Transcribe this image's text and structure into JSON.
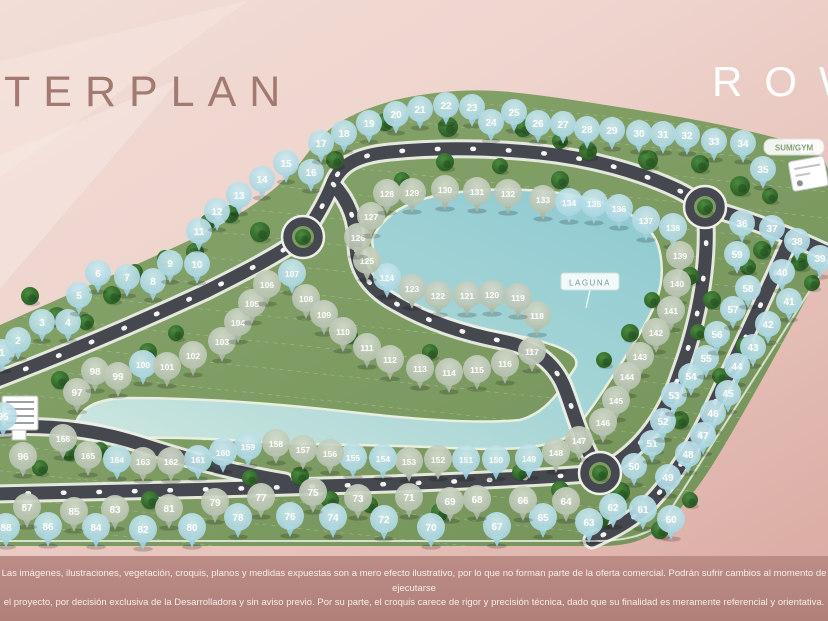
{
  "meta": {
    "title": "TERPLAN",
    "brand": "ROW"
  },
  "labels": {
    "laguna": "LAGUNA",
    "amenity": "SUM/GYM"
  },
  "disclaimer": {
    "line1": "Las imágenes, ilustraciones, vegetación, croquis, planos y medidas expuestas son a mero efecto ilustrativo, por lo que no forman parte de la oferta comercial. Podrán sufrir cambios al momento de ejecutarse",
    "line2": "el proyecto, por decisión exclusiva de la Desarrolladora y sin aviso previo. Por su parte, el croquis carece de rigor y precisión técnica, dado que su finalidad es meramente referencial y orientativa."
  },
  "colors": {
    "marker_blue": "#a9d8e4",
    "marker_sage": "#b6c2b2",
    "road": "#45484e",
    "terrain": "#7e9c62",
    "water": "#9fd2d8",
    "band": "#ba8c85",
    "title": "#a27a72",
    "brand_text": "#ffffff"
  },
  "map": {
    "markers": [
      [
        1,
        2,
        352,
        "b"
      ],
      [
        2,
        18,
        340,
        "b"
      ],
      [
        3,
        42,
        322,
        "b"
      ],
      [
        4,
        68,
        322,
        "b"
      ],
      [
        5,
        79,
        295,
        "b"
      ],
      [
        6,
        98,
        273,
        "b"
      ],
      [
        7,
        127,
        277,
        "b"
      ],
      [
        8,
        153,
        281,
        "b"
      ],
      [
        9,
        170,
        263,
        "b"
      ],
      [
        10,
        197,
        264,
        "b"
      ],
      [
        11,
        199,
        231,
        "b"
      ],
      [
        12,
        217,
        211,
        "b"
      ],
      [
        13,
        239,
        195,
        "b"
      ],
      [
        14,
        262,
        179,
        "b"
      ],
      [
        15,
        286,
        163,
        "b"
      ],
      [
        16,
        311,
        172,
        "b"
      ],
      [
        17,
        321,
        143,
        "b"
      ],
      [
        18,
        344,
        133,
        "b"
      ],
      [
        19,
        369,
        123,
        "b"
      ],
      [
        20,
        396,
        114,
        "b"
      ],
      [
        21,
        420,
        109,
        "b"
      ],
      [
        22,
        446,
        105,
        "b"
      ],
      [
        23,
        472,
        107,
        "b"
      ],
      [
        24,
        491,
        122,
        "b"
      ],
      [
        25,
        514,
        112,
        "b"
      ],
      [
        26,
        538,
        123,
        "b"
      ],
      [
        27,
        563,
        124,
        "b"
      ],
      [
        28,
        587,
        129,
        "b"
      ],
      [
        29,
        612,
        130,
        "b"
      ],
      [
        30,
        639,
        133,
        "b"
      ],
      [
        31,
        663,
        134,
        "b"
      ],
      [
        32,
        687,
        135,
        "b"
      ],
      [
        33,
        714,
        141,
        "b"
      ],
      [
        34,
        743,
        143,
        "b"
      ],
      [
        35,
        763,
        169,
        "b"
      ],
      [
        36,
        742,
        223,
        "b"
      ],
      [
        37,
        772,
        228,
        "b"
      ],
      [
        38,
        797,
        241,
        "b"
      ],
      [
        39,
        820,
        258,
        "b"
      ],
      [
        40,
        782,
        272,
        "b"
      ],
      [
        41,
        789,
        301,
        "b"
      ],
      [
        42,
        768,
        324,
        "b"
      ],
      [
        43,
        753,
        347,
        "b"
      ],
      [
        44,
        737,
        366,
        "b"
      ],
      [
        45,
        728,
        393,
        "b"
      ],
      [
        46,
        713,
        413,
        "b"
      ],
      [
        47,
        703,
        435,
        "b"
      ],
      [
        48,
        688,
        454,
        "b"
      ],
      [
        49,
        668,
        477,
        "b"
      ],
      [
        50,
        634,
        466,
        "b"
      ],
      [
        51,
        652,
        443,
        "b"
      ],
      [
        52,
        663,
        421,
        "b"
      ],
      [
        53,
        674,
        395,
        "b"
      ],
      [
        54,
        691,
        376,
        "b"
      ],
      [
        55,
        706,
        358,
        "b"
      ],
      [
        56,
        717,
        334,
        "b"
      ],
      [
        57,
        733,
        309,
        "b"
      ],
      [
        58,
        748,
        288,
        "b"
      ],
      [
        59,
        737,
        254,
        "b"
      ],
      [
        60,
        671,
        519,
        "b"
      ],
      [
        61,
        643,
        509,
        "b"
      ],
      [
        62,
        613,
        507,
        "b"
      ],
      [
        63,
        589,
        522,
        "b"
      ],
      [
        64,
        566,
        501,
        "s"
      ],
      [
        65,
        543,
        517,
        "b"
      ],
      [
        66,
        523,
        500,
        "s"
      ],
      [
        67,
        497,
        526,
        "b"
      ],
      [
        68,
        477,
        499,
        "s"
      ],
      [
        69,
        450,
        501,
        "s"
      ],
      [
        70,
        431,
        527,
        "b"
      ],
      [
        71,
        409,
        497,
        "s"
      ],
      [
        72,
        384,
        519,
        "b"
      ],
      [
        73,
        358,
        498,
        "s"
      ],
      [
        74,
        333,
        517,
        "b"
      ],
      [
        75,
        313,
        492,
        "s"
      ],
      [
        76,
        290,
        516,
        "b"
      ],
      [
        77,
        261,
        497,
        "s"
      ],
      [
        78,
        238,
        517,
        "b"
      ],
      [
        79,
        215,
        502,
        "s"
      ],
      [
        80,
        192,
        527,
        "b"
      ],
      [
        81,
        169,
        508,
        "s"
      ],
      [
        82,
        143,
        529,
        "b"
      ],
      [
        83,
        115,
        509,
        "s"
      ],
      [
        84,
        96,
        527,
        "b"
      ],
      [
        85,
        74,
        511,
        "s"
      ],
      [
        86,
        48,
        526,
        "b"
      ],
      [
        87,
        27,
        507,
        "s"
      ],
      [
        88,
        6,
        527,
        "b"
      ],
      [
        95,
        3,
        416,
        "b"
      ],
      [
        96,
        23,
        456,
        "s"
      ],
      [
        97,
        77,
        392,
        "s"
      ],
      [
        98,
        95,
        371,
        "s"
      ],
      [
        99,
        118,
        376,
        "s"
      ],
      [
        100,
        143,
        364,
        "b"
      ],
      [
        101,
        167,
        366,
        "s"
      ],
      [
        102,
        193,
        355,
        "s"
      ],
      [
        103,
        222,
        341,
        "s"
      ],
      [
        104,
        238,
        322,
        "s"
      ],
      [
        105,
        252,
        303,
        "s"
      ],
      [
        106,
        267,
        284,
        "s"
      ],
      [
        107,
        292,
        273,
        "b"
      ],
      [
        108,
        306,
        298,
        "s"
      ],
      [
        109,
        324,
        314,
        "s"
      ],
      [
        110,
        343,
        331,
        "s"
      ],
      [
        111,
        367,
        347,
        "s"
      ],
      [
        112,
        390,
        359,
        "s"
      ],
      [
        113,
        420,
        368,
        "s"
      ],
      [
        114,
        449,
        372,
        "s"
      ],
      [
        115,
        477,
        369,
        "s"
      ],
      [
        116,
        505,
        363,
        "s"
      ],
      [
        117,
        532,
        351,
        "s"
      ],
      [
        118,
        537,
        315,
        "s"
      ],
      [
        119,
        518,
        297,
        "s"
      ],
      [
        120,
        492,
        294,
        "s"
      ],
      [
        121,
        467,
        295,
        "s"
      ],
      [
        122,
        438,
        295,
        "s"
      ],
      [
        123,
        412,
        288,
        "s"
      ],
      [
        124,
        387,
        277,
        "b"
      ],
      [
        125,
        367,
        260,
        "s"
      ],
      [
        126,
        358,
        237,
        "s"
      ],
      [
        127,
        371,
        216,
        "s"
      ],
      [
        128,
        387,
        193,
        "s"
      ],
      [
        129,
        412,
        192,
        "s"
      ],
      [
        130,
        445,
        189,
        "s"
      ],
      [
        131,
        477,
        191,
        "s"
      ],
      [
        132,
        508,
        193,
        "s"
      ],
      [
        133,
        543,
        199,
        "s"
      ],
      [
        134,
        569,
        202,
        "b"
      ],
      [
        135,
        594,
        203,
        "b"
      ],
      [
        136,
        619,
        208,
        "b"
      ],
      [
        137,
        646,
        220,
        "b"
      ],
      [
        138,
        673,
        227,
        "b"
      ],
      [
        139,
        680,
        255,
        "s"
      ],
      [
        140,
        677,
        283,
        "s"
      ],
      [
        141,
        671,
        310,
        "s"
      ],
      [
        142,
        656,
        332,
        "s"
      ],
      [
        143,
        640,
        356,
        "s"
      ],
      [
        144,
        627,
        376,
        "s"
      ],
      [
        145,
        616,
        400,
        "s"
      ],
      [
        146,
        603,
        422,
        "s"
      ],
      [
        147,
        579,
        440,
        "s"
      ],
      [
        148,
        556,
        452,
        "s"
      ],
      [
        149,
        529,
        458,
        "b"
      ],
      [
        150,
        496,
        459,
        "b"
      ],
      [
        151,
        466,
        459,
        "b"
      ],
      [
        152,
        438,
        459,
        "s"
      ],
      [
        153,
        409,
        461,
        "s"
      ],
      [
        154,
        383,
        458,
        "b"
      ],
      [
        155,
        353,
        457,
        "b"
      ],
      [
        156,
        330,
        453,
        "s"
      ],
      [
        157,
        303,
        449,
        "s"
      ],
      [
        158,
        276,
        443,
        "s"
      ],
      [
        159,
        248,
        446,
        "b"
      ],
      [
        160,
        223,
        452,
        "b"
      ],
      [
        161,
        198,
        459,
        "b"
      ],
      [
        162,
        171,
        461,
        "s"
      ],
      [
        163,
        143,
        461,
        "s"
      ],
      [
        164,
        117,
        459,
        "b"
      ],
      [
        165,
        88,
        455,
        "s"
      ],
      [
        166,
        63,
        438,
        "s"
      ]
    ],
    "trees": [
      [
        30,
        296,
        9
      ],
      [
        57,
        317,
        10
      ],
      [
        86,
        322,
        8
      ],
      [
        112,
        295,
        9
      ],
      [
        135,
        272,
        8
      ],
      [
        165,
        258,
        8
      ],
      [
        148,
        352,
        9
      ],
      [
        176,
        333,
        8
      ],
      [
        195,
        252,
        9
      ],
      [
        208,
        222,
        8
      ],
      [
        230,
        214,
        9
      ],
      [
        260,
        232,
        10
      ],
      [
        292,
        242,
        8
      ],
      [
        335,
        160,
        9
      ],
      [
        385,
        122,
        9
      ],
      [
        448,
        127,
        10
      ],
      [
        402,
        180,
        8
      ],
      [
        445,
        162,
        9
      ],
      [
        500,
        166,
        8
      ],
      [
        560,
        180,
        9
      ],
      [
        523,
        128,
        9
      ],
      [
        560,
        141,
        8
      ],
      [
        588,
        151,
        9
      ],
      [
        648,
        160,
        10
      ],
      [
        700,
        164,
        9
      ],
      [
        740,
        186,
        10
      ],
      [
        770,
        196,
        8
      ],
      [
        762,
        250,
        9
      ],
      [
        748,
        267,
        8
      ],
      [
        690,
        276,
        9
      ],
      [
        652,
        300,
        8
      ],
      [
        712,
        300,
        9
      ],
      [
        698,
        332,
        8
      ],
      [
        630,
        333,
        9
      ],
      [
        604,
        360,
        8
      ],
      [
        800,
        262,
        9
      ],
      [
        812,
        283,
        8
      ],
      [
        745,
        346,
        9
      ],
      [
        720,
        376,
        8
      ],
      [
        680,
        420,
        9
      ],
      [
        655,
        446,
        8
      ],
      [
        60,
        380,
        9
      ],
      [
        40,
        468,
        8
      ],
      [
        70,
        452,
        9
      ],
      [
        100,
        450,
        8
      ],
      [
        150,
        500,
        9
      ],
      [
        205,
        462,
        8
      ],
      [
        250,
        478,
        8
      ],
      [
        300,
        476,
        9
      ],
      [
        330,
        500,
        9
      ],
      [
        370,
        505,
        8
      ],
      [
        440,
        512,
        9
      ],
      [
        520,
        472,
        8
      ],
      [
        560,
        490,
        9
      ],
      [
        620,
        492,
        10
      ],
      [
        640,
        505,
        8
      ],
      [
        600,
        520,
        9
      ],
      [
        660,
        530,
        9
      ],
      [
        690,
        500,
        8
      ],
      [
        350,
        336,
        8
      ],
      [
        430,
        352,
        8
      ]
    ],
    "roundabouts": [
      [
        303,
        237
      ],
      [
        705,
        207
      ],
      [
        600,
        473
      ]
    ]
  }
}
